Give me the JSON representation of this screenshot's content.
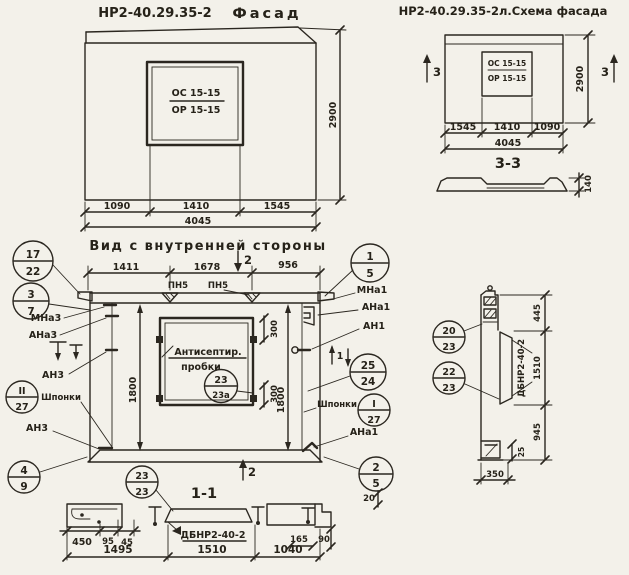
{
  "colors": {
    "paper": "#f3f1ea",
    "ink": "#2b2720"
  },
  "titles": {
    "facade_code": "НР2-40.29.35-2",
    "facade_word": "Фасад",
    "schema": "НР2-40.29.35-2л.Схема фасада",
    "inner_heading": "Вид с внутренней стороны",
    "section_1_1": "1-1",
    "section_3_3": "3-3"
  },
  "facade": {
    "window_mark_top": "ОС 15-15",
    "window_mark_bot": "ОР 15-15",
    "height": "2900",
    "w1": "1090",
    "w2": "1410",
    "w3": "1545",
    "total": "4045"
  },
  "schema": {
    "window_mark_top": "ОС 15-15",
    "window_mark_bot": "ОР 15-15",
    "height": "2900",
    "w1": "1545",
    "w2": "1410",
    "w3": "1090",
    "total": "4045",
    "mark_left": "3",
    "mark_right": "3",
    "thickness": "140"
  },
  "inner": {
    "d1": "1411",
    "d2": "1678",
    "d3": "956",
    "loop1": "ПН5",
    "loop2": "ПН5",
    "sec2_top": "2",
    "sec2_bot": "2",
    "sec1": "1",
    "v_left": "1800",
    "v_right": "1800",
    "win_top": "300",
    "win_bot": "300",
    "note1": "Антисептир.",
    "note2": "пробки",
    "lbl_mna3": "МНа3",
    "lbl_ana3": "АНа3",
    "lbl_an3": "АН3",
    "lbl_shponki_l": "Шпонки",
    "lbl_an3b": "АН3",
    "lbl_mna1": "МНа1",
    "lbl_ana1": "АНа1",
    "lbl_an1": "АН1",
    "lbl_shponki_r": "Шпонки",
    "lbl_ana1b": "АНа1"
  },
  "callouts": {
    "c17_22": {
      "top": "17",
      "bot": "22"
    },
    "c3_7": {
      "top": "3",
      "bot": "7"
    },
    "cII_27": {
      "top": "II",
      "bot": "27"
    },
    "c4_9": {
      "top": "4",
      "bot": "9"
    },
    "c1_5": {
      "top": "1",
      "bot": "5"
    },
    "c25_24": {
      "top": "25",
      "bot": "24"
    },
    "cI_27": {
      "top": "I",
      "bot": "27"
    },
    "c2_5": {
      "top": "2",
      "bot": "5"
    },
    "c23_23a": {
      "top": "23",
      "bot": "23а"
    },
    "c23_23": {
      "top": "23",
      "bot": "23"
    },
    "c20_23": {
      "top": "20",
      "bot": "23"
    },
    "c22_23": {
      "top": "22",
      "bot": "23"
    }
  },
  "section11": {
    "s450": "450",
    "s95": "95",
    "s45": "45",
    "m1": "1495",
    "m2": "1510",
    "m3": "1040",
    "d165": "165",
    "d90": "90",
    "d20": "20",
    "panel_mark": "ДБНР2-40-2"
  },
  "rightsec": {
    "d445": "445",
    "d1510": "1510",
    "d945": "945",
    "d350": "350",
    "d25": "25",
    "panel_mark": "ДБНР2-40-2"
  }
}
